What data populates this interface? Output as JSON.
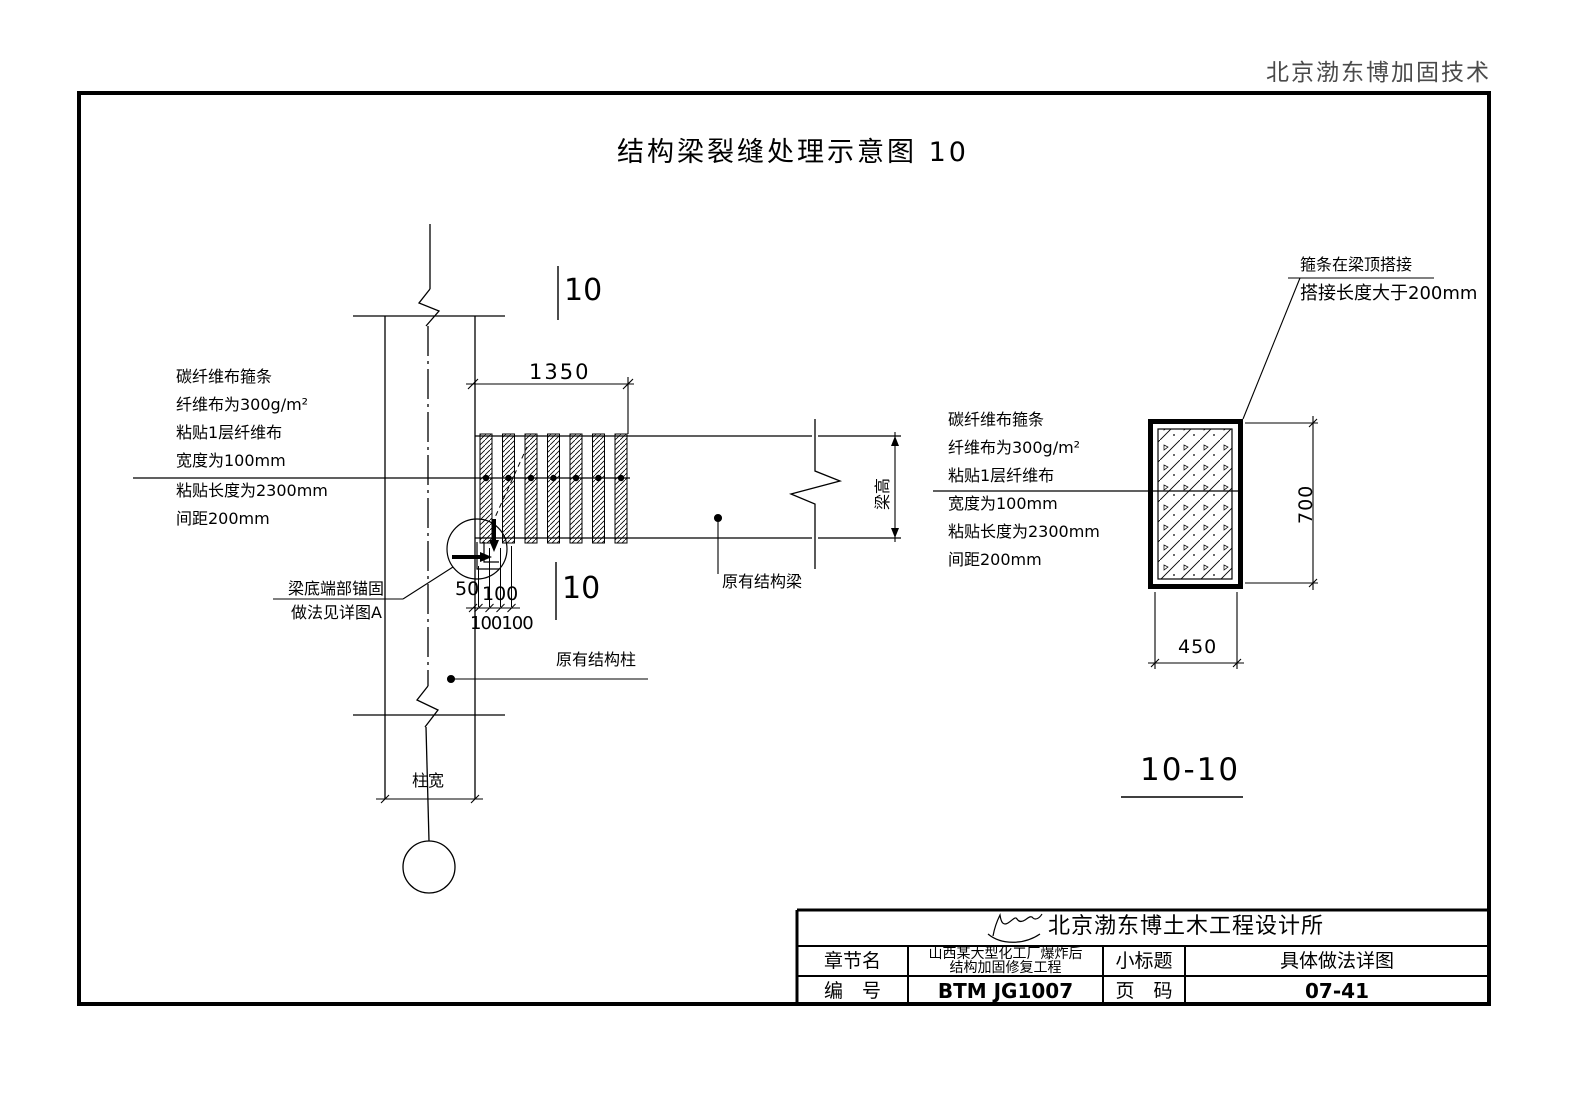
{
  "header": {
    "vendor": "北京渤东博加固技术"
  },
  "drawing": {
    "title": "结构梁裂缝处理示意图 10",
    "section_title": "10-10",
    "marker_upper": "10",
    "marker_lower": "10",
    "labels": {
      "existing_beam": "原有结构梁",
      "existing_column": "原有结构柱",
      "column_width": "柱宽",
      "beam_height": "梁高"
    },
    "notes": {
      "cfrp_left": [
        "碳纤维布箍条",
        "纤维布为300g/m²",
        "粘贴1层纤维布",
        "宽度为100mm",
        "粘贴长度为2300mm",
        "间距200mm"
      ],
      "cfrp_right": [
        "碳纤维布箍条",
        "纤维布为300g/m²",
        "粘贴1层纤维布",
        "宽度为100mm",
        "粘贴长度为2300mm",
        "间距200mm"
      ],
      "lap_line1": "箍条在梁顶搭接",
      "lap_line2": "搭接长度大于200mm",
      "anchor_line1": "梁底端部锚固",
      "anchor_line2": "做法见详图A"
    },
    "dims": {
      "strip_zone": "1350",
      "offset_50": "50",
      "spacing_100": "100",
      "spacing_100100": "100100",
      "section_height": "700",
      "section_width": "450"
    }
  },
  "title_block": {
    "company": "北京渤东博土木工程设计所",
    "chapter_label": "章节名",
    "chapter_value_line1": "山西某大型化工厂爆炸后",
    "chapter_value_line2": "结构加固修复工程",
    "subtitle_label": "小标题",
    "subtitle_value": "具体做法详图",
    "number_label": "编　号",
    "number_value": "BTM JG1007",
    "page_label": "页　码",
    "page_value": "07-41"
  },
  "colors": {
    "line": "#000000",
    "vendor_text": "#4a4a4a",
    "paper": "#ffffff"
  }
}
